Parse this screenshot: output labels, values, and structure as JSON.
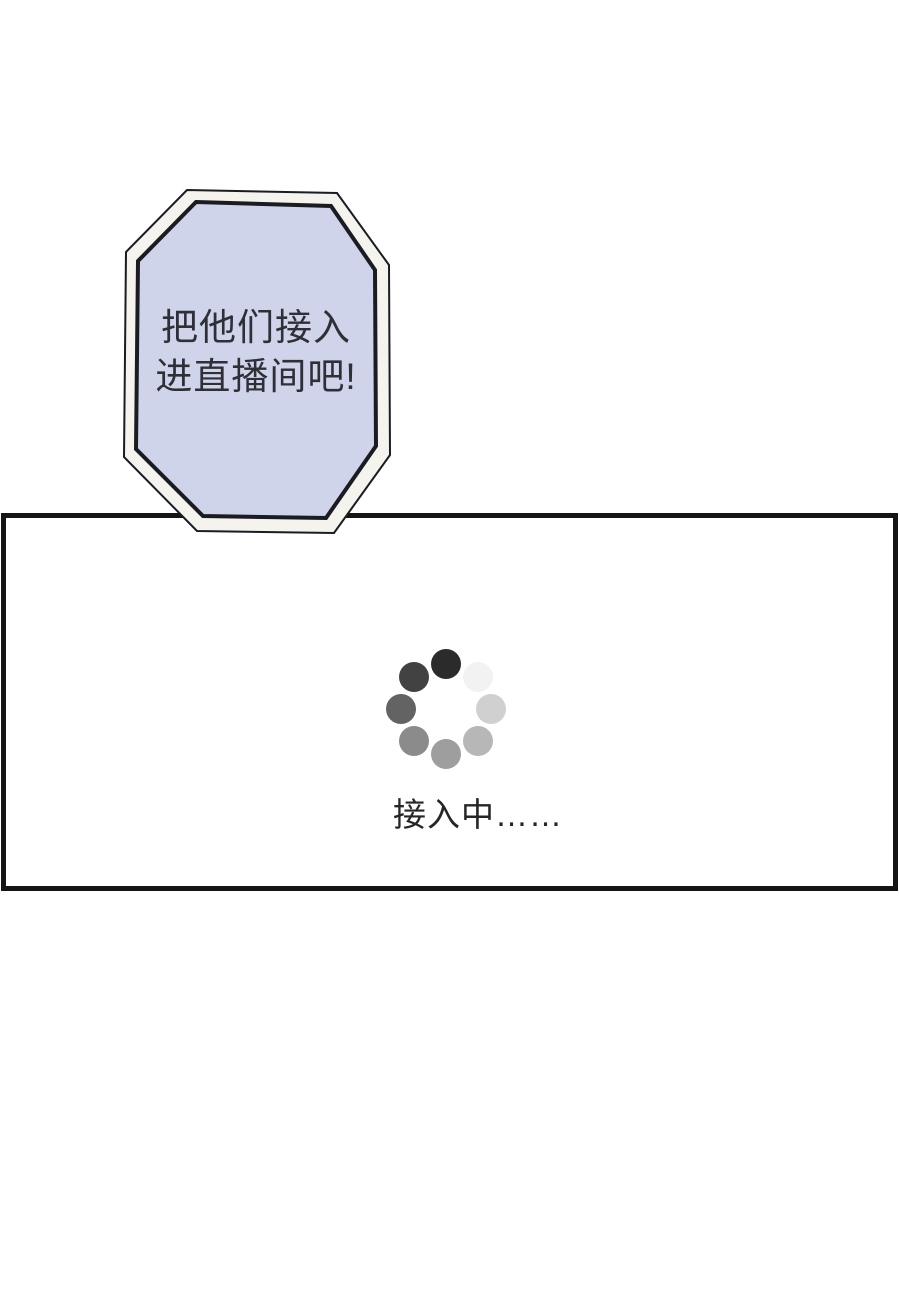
{
  "page": {
    "background": "#ffffff"
  },
  "speech_bubble": {
    "line1": "把他们接入",
    "line2": "进直播间吧!",
    "fill_color": "#cfd4ea",
    "band_color": "#f5f3ee",
    "outline_color": "#1b1b22",
    "text_color": "#2f2f37"
  },
  "panel": {
    "border_color": "#151515",
    "background": "#ffffff",
    "status_text": "接入中……",
    "status_text_color": "#262626",
    "spinner": {
      "icon": "loading-spinner-icon",
      "dot_colors": [
        "#2b2b2b",
        "#424242",
        "#636363",
        "#8b8b8b",
        "#9e9e9e",
        "#b7b7b7",
        "#d0d0d0",
        "#f2f2f2"
      ],
      "dot_angles_deg": [
        90,
        135,
        180,
        225,
        270,
        315,
        0,
        45
      ],
      "orbit_radius_px": 45,
      "dot_diameter_px": 30
    }
  }
}
